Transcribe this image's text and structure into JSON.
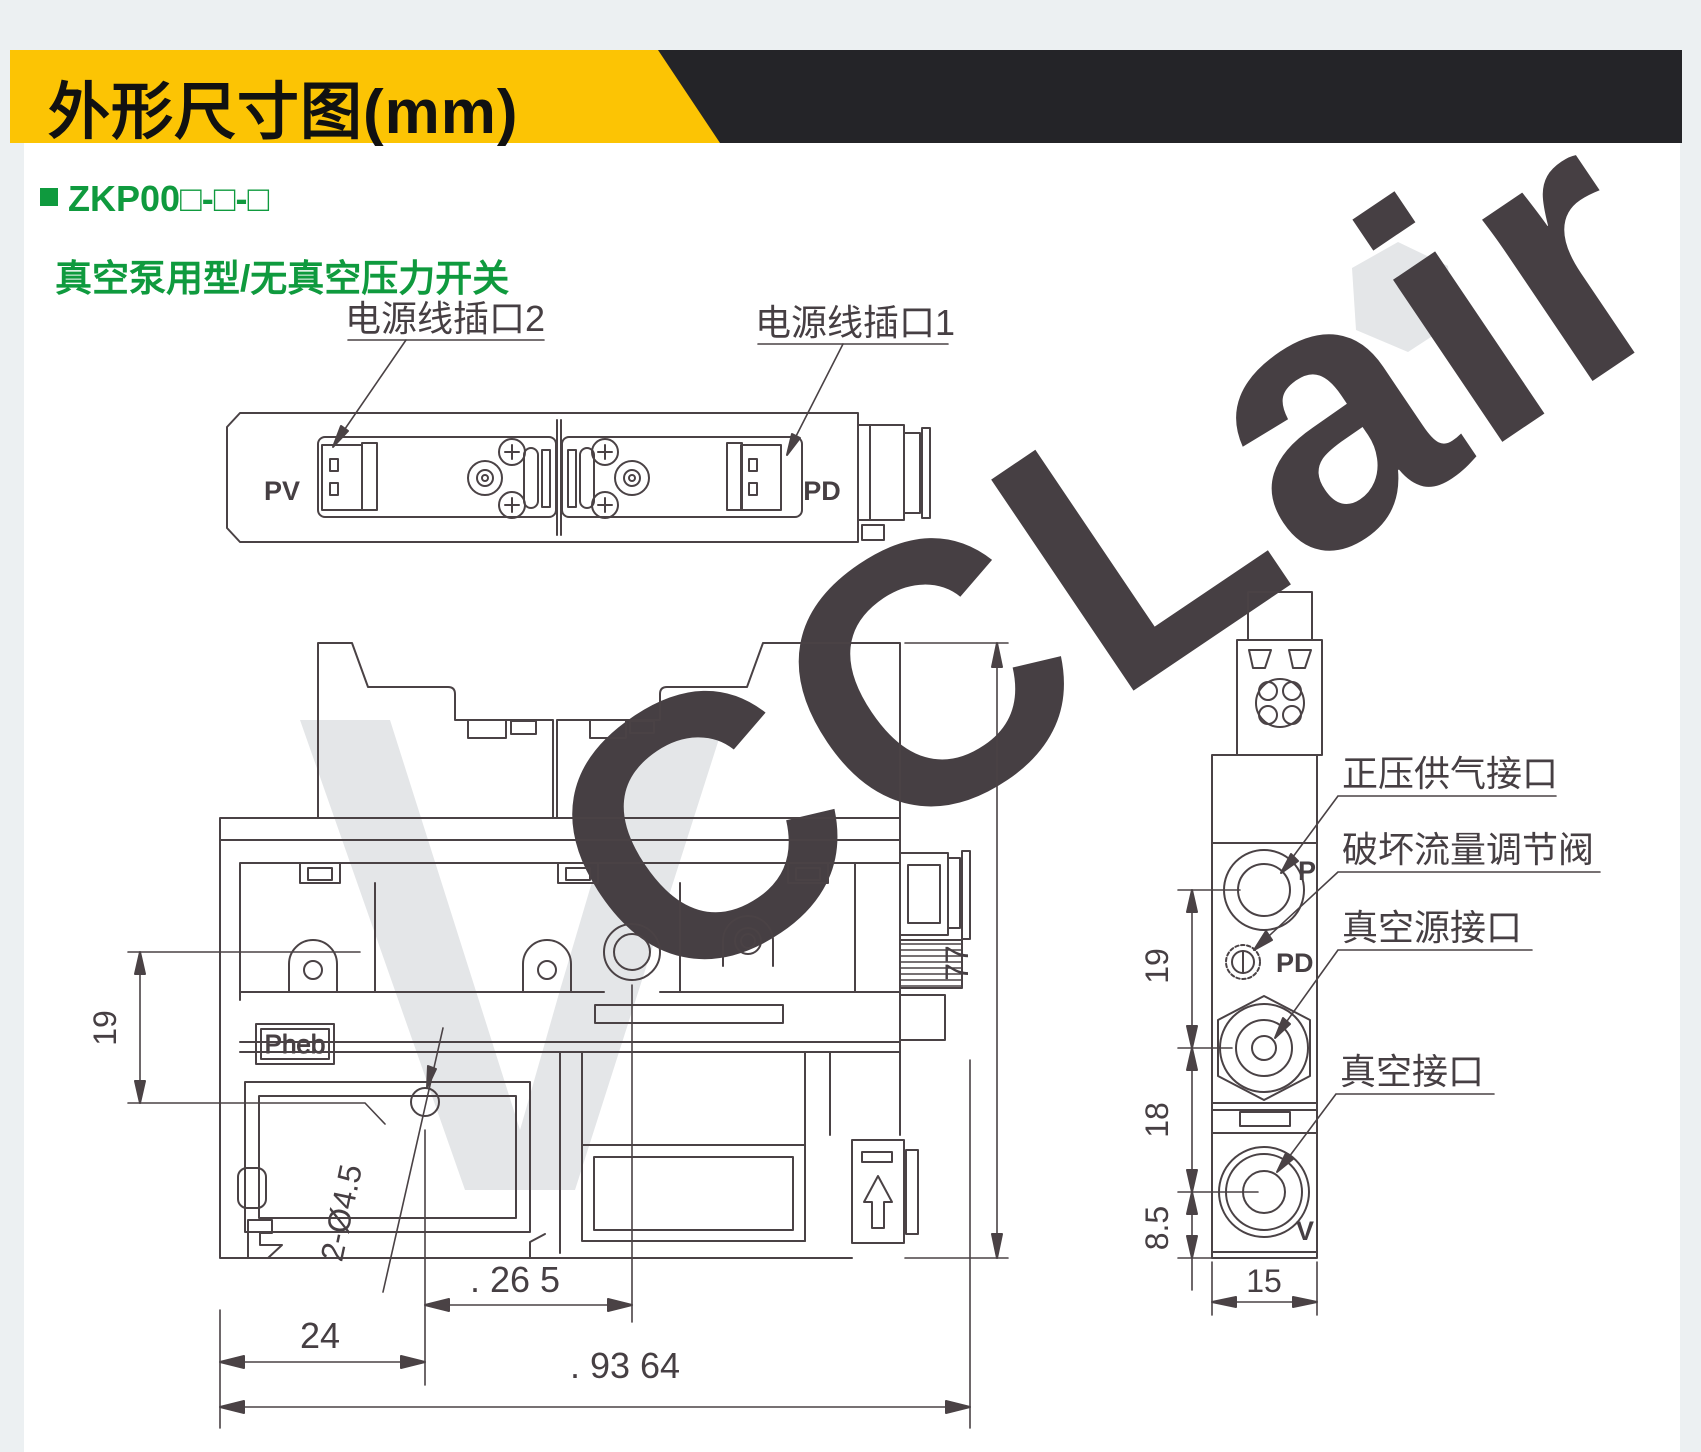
{
  "header": {
    "title": "外形尺寸图(mm)",
    "accent_color": "#fcc404",
    "bar_color": "#242428"
  },
  "model": {
    "code": "ZKP00□-□-□",
    "subtitle": "真空泵用型/无真空压力开关",
    "green": "#0f9a3e"
  },
  "watermark": {
    "text": "CCLair",
    "color": "#e4e6e8"
  },
  "top_view": {
    "label_power_port_2": "电源线插口2",
    "label_power_port_1": "电源线插口1",
    "pv": "PV",
    "pd": "PD"
  },
  "front_view": {
    "brand": "Pheb",
    "dim_height_19": "19",
    "dim_height_77": "77",
    "dim_24": "24",
    "dim_holes": "2-Ø4.5",
    "dim_26_5": ". 26 5",
    "dim_93_64": ". 93 64"
  },
  "side_view": {
    "port_p": "P",
    "port_pd": "PD",
    "port_v": "V",
    "dim_19": "19",
    "dim_18": "18",
    "dim_8_5": "8.5",
    "dim_15": "15",
    "label_supply": "正压供气接口",
    "label_break_valve": "破坏流量调节阀",
    "label_vacuum_source": "真空源接口",
    "label_vacuum": "真空接口"
  },
  "line_color": "#4a4245"
}
